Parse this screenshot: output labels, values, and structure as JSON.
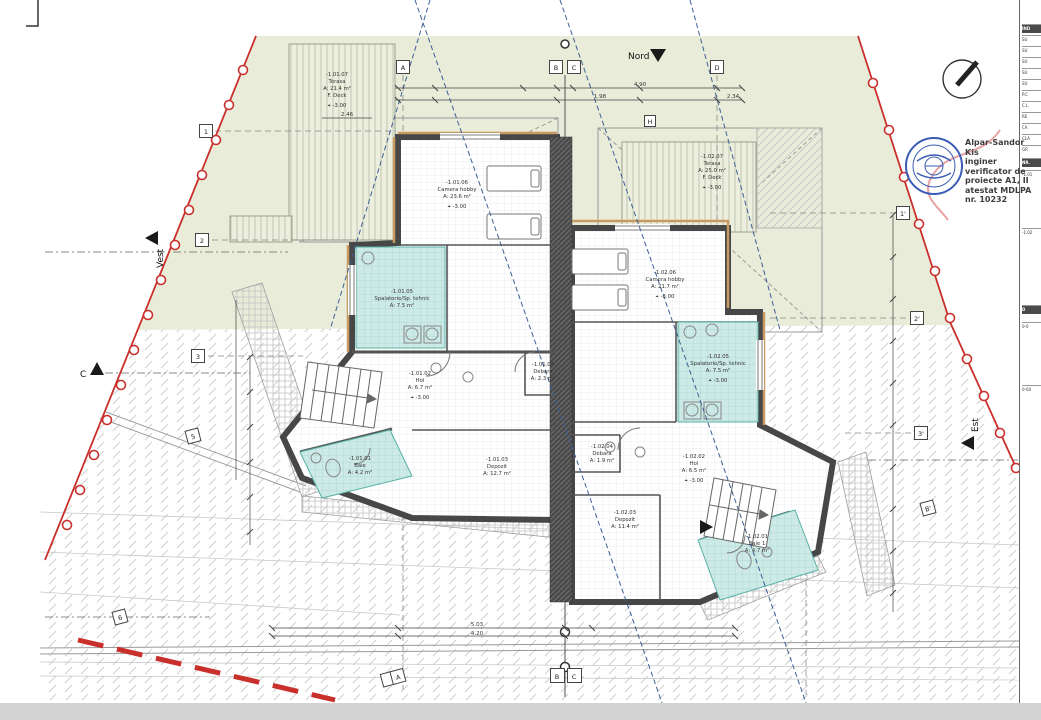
{
  "compass": {
    "north": "Nord",
    "west": "Vest",
    "east": "Est",
    "section_c": "C"
  },
  "icons": {
    "level_mark": "⌖",
    "north_arrow": "▼"
  },
  "rooms": [
    {
      "code": "-1.01.07",
      "name": "Terasa",
      "area": "A: 21.4 m²",
      "finish": "F. Deck",
      "level": "-3.00"
    },
    {
      "code": "-1.01.06",
      "name": "Camera hobby",
      "area": "A: 23.6 m²",
      "level": "-3.00"
    },
    {
      "code": "-1.01.05",
      "name": "Spalatorie/Sp. tehnic",
      "area": "A: 7.5 m²"
    },
    {
      "code": "-1.01.02",
      "name": "Hol",
      "area": "A: 6.7 m²",
      "level": "-3.00"
    },
    {
      "code": "-1.01.04",
      "name": "Debara",
      "area": "A: 2.3 m²"
    },
    {
      "code": "-1.01.01",
      "name": "Baie",
      "area": "A: 4.2 m²"
    },
    {
      "code": "-1.01.03",
      "name": "Depozit",
      "area": "A: 12.7 m²"
    },
    {
      "code": "-1.02.07",
      "name": "Terasa",
      "area": "A: 25.0 m²",
      "finish": "F. Deck",
      "level": "-3.00"
    },
    {
      "code": "-1.02.06",
      "name": "Camera hobby",
      "area": "A: 21.7 m²",
      "level": "-3.00"
    },
    {
      "code": "-1.02.05",
      "name": "Spalatorie/Sp. tehnic",
      "area": "A: 7.5 m²",
      "level": "-3.00"
    },
    {
      "code": "-1.02.04",
      "name": "Debara",
      "area": "A: 1.9 m²"
    },
    {
      "code": "-1.02.02",
      "name": "Hol",
      "area": "A: 6.5 m²",
      "level": "-3.00"
    },
    {
      "code": "-1.02.03",
      "name": "Depozit",
      "area": "A: 11.4 m²"
    },
    {
      "code": "-1.02.01",
      "name": "Baie 1",
      "area": "A: 4.7 m²"
    }
  ],
  "grid_markers": [
    "A",
    "B",
    "C",
    "D",
    "H",
    "1",
    "2",
    "3",
    "5",
    "6",
    "1'",
    "2'",
    "3'",
    "B'",
    "A",
    "B",
    "C"
  ],
  "dimensions": {
    "top": [
      "2.46",
      "4.90",
      "1.98",
      "2.34"
    ],
    "bottom": [
      "5.03",
      "4.20"
    ]
  },
  "verifier_stamp": {
    "name": "Alpar-Sandor Kis",
    "role": "inginer",
    "line3": "verificator de",
    "line4": "proiecte A1, II",
    "line5": "atestat MDLPA",
    "line6": "nr. 10232"
  },
  "title_strip": {
    "rows": [
      "IND",
      "SU",
      "SU",
      "SU",
      "SU",
      "SU",
      "P.C",
      "C.L",
      "RE",
      "CA",
      "CLA",
      "GR",
      "NR.",
      "-1.01",
      "-1.02",
      "D",
      "0-0",
      "0-04"
    ]
  },
  "colors": {
    "site_green": "#e9ecd9",
    "boundary_red": "#c9302c",
    "tile_cyan": "#cdeae7",
    "wall_dark": "#474747",
    "insulation_tan": "#c89a62",
    "setback_blue": "#3d5f94",
    "stamp_blue": "#3a5cb5"
  }
}
